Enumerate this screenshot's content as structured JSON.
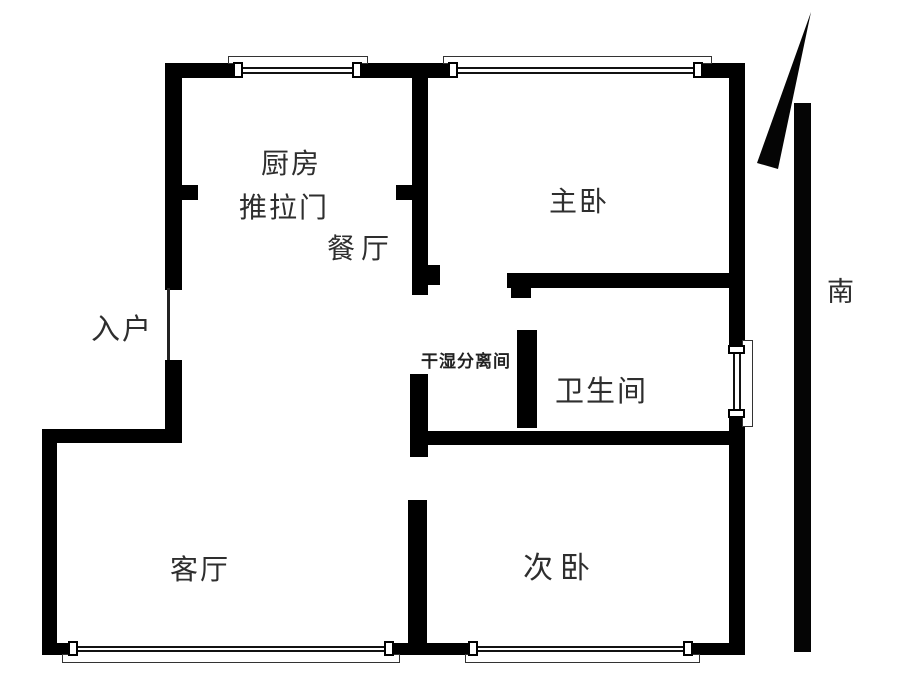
{
  "floorplan": {
    "rooms": {
      "kitchen": "厨房",
      "sliding_door": "推拉门",
      "dining": "餐厅",
      "master_bedroom": "主卧",
      "entrance": "入户",
      "dry_wet_area": "干湿分离间",
      "bathroom": "卫生间",
      "living_room": "客厅",
      "second_bedroom": "次卧"
    },
    "compass": {
      "south": "南"
    },
    "colors": {
      "wall": "#000000",
      "background": "#ffffff",
      "text": "#2e2e2e"
    }
  }
}
